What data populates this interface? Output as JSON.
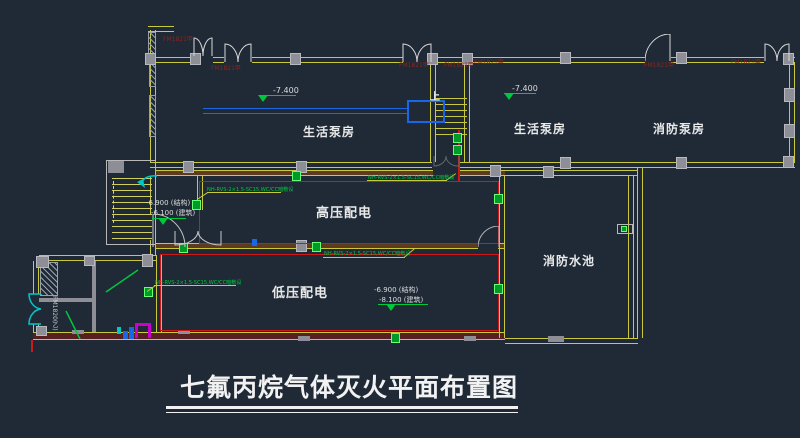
{
  "drawing": {
    "title": "七氟丙烷气体灭火平面布置图"
  },
  "rooms": {
    "pump_room_top_left": "生活泵房",
    "pump_room_top_right": "生活泵房",
    "fire_pump_room": "消防泵房",
    "high_voltage_room": "高压配电",
    "low_voltage_room": "低压配电",
    "fire_water_pool": "消防水池"
  },
  "elevations": {
    "pump_left": "-7.400",
    "pump_right": "-7.400",
    "hv_structural": "-6.900 (结构)",
    "hv_architectural": "-6.100 (建筑)",
    "lv_structural": "-6.900 (结构)",
    "lv_architectural": "-8.100 (建筑)"
  },
  "labels": {
    "fire_door": "FM1821甲",
    "fire_door_side": "FM1820(乙)",
    "stair_up": "上",
    "conduit_spec": "NH-RVS-2×1.5-SC15,WC/CC暗敷设"
  },
  "colors": {
    "background": "#1f2a36",
    "wall_yellow": "#c9c93e",
    "line_red": "#d01818",
    "green": "#00c83c",
    "cyan": "#00c8c8",
    "blue": "#1966e6",
    "magenta": "#cc00cc",
    "column_gray": "#8e8e96",
    "text_white": "#e9e9e9",
    "door_label_red": "#8a241c",
    "wall_fill_brown": "#5e3a1e",
    "wall_fill_maroon": "#571f1f"
  }
}
